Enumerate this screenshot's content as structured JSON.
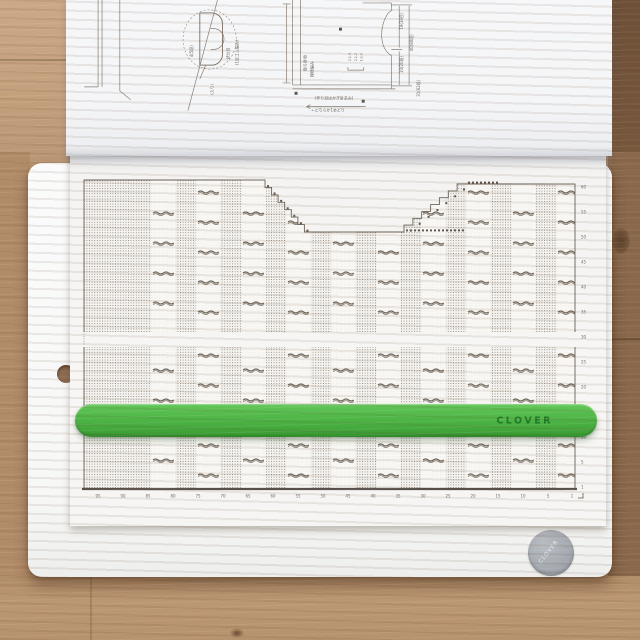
{
  "ruler": {
    "brand": "CLOVER",
    "color": "#4cb043"
  },
  "badge": {
    "text": "CLOVER"
  },
  "knitting_chart": {
    "bottom_numbers": [
      "95",
      "90",
      "85",
      "80",
      "75",
      "70",
      "65",
      "60",
      "55",
      "50",
      "45",
      "40",
      "35",
      "30",
      "25",
      "20",
      "15",
      "10",
      "5",
      "1"
    ],
    "right_numbers": [
      "60",
      "55",
      "50",
      "45",
      "40",
      "35",
      "30",
      "25",
      "20",
      "15",
      "10",
      "5",
      "1"
    ],
    "cable_bands": {
      "start_x": 81,
      "period": 45,
      "width": 25,
      "count": 10
    },
    "squiggle_row_step": 30
  },
  "schematic": {
    "labels": {
      "neck_left": "4(5段)",
      "neck_mid": "伏せ目",
      "neck_right": "(1目ゴム編み)",
      "neck_bottom": "(えり)",
      "body_name": "後ろ身頃",
      "body_stitch": "模様編み",
      "dim_right_top": "19(38目)",
      "dim_right_bottom": "10(20段)",
      "dim_far_right": "40(80段)",
      "dim_far_right2": "31(62段)",
      "bottom_note1": "(作り目はかぎ針あみ)",
      "bottom_note2": "←どちらか1本どり"
    },
    "shaping": [
      "2-1-3",
      "2-1-2",
      "1-1-2"
    ]
  }
}
